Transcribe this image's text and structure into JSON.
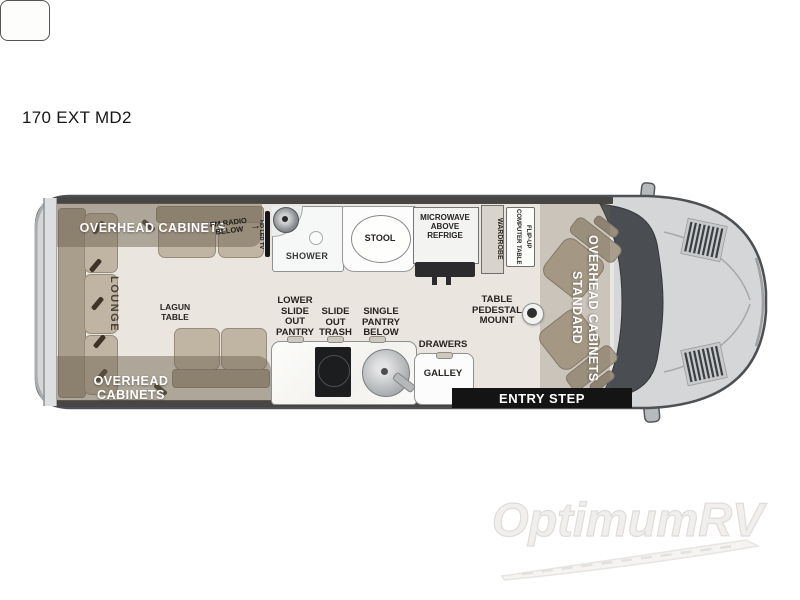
{
  "title": "170 EXT MD2",
  "watermark": "OptimumRV",
  "icons": {
    "arrow_right": "→"
  },
  "labels": {
    "overhead_cabinets_rear_top": "OVERHEAD CABINETS",
    "overhead_cabinets_rear_bottom": "OVERHEAD CABINETS",
    "lounge": "LOUNGE",
    "lagun_table": "LAGUN TABLE",
    "fm_radio_below": "FM RADIO BELOW",
    "hd_led_tv": "HD LED TV",
    "shower": "SHOWER",
    "stool": "STOOL",
    "microwave_above_refrige": "MICROWAVE ABOVE REFRIGE",
    "wardrobe": "WARDROBE",
    "flip_up_computer_table": "FLIP-UP COMPUTER TABLE",
    "overhead_cabinets_standard": "OVERHEAD CABINETS STANDARD",
    "lower_slide_out_pantry": "LOWER SLIDE OUT PANTRY",
    "slide_out_trash": "SLIDE OUT TRASH",
    "single_pantry_below": "SINGLE PANTRY BELOW",
    "drawers": "DRAWERS",
    "galley": "GALLEY",
    "table_pedestal_mount": "TABLE PEDESTAL MOUNT",
    "entry_step": "ENTRY STEP"
  },
  "colors": {
    "van_body": "#d4d6d8",
    "floor": "#eae6df",
    "cushion": "#c0b4a2",
    "cabinet_overlay": "rgba(112,101,83,0.5)",
    "dark_fixture": "#141414",
    "watermark_gray": "#e4e2e0"
  }
}
